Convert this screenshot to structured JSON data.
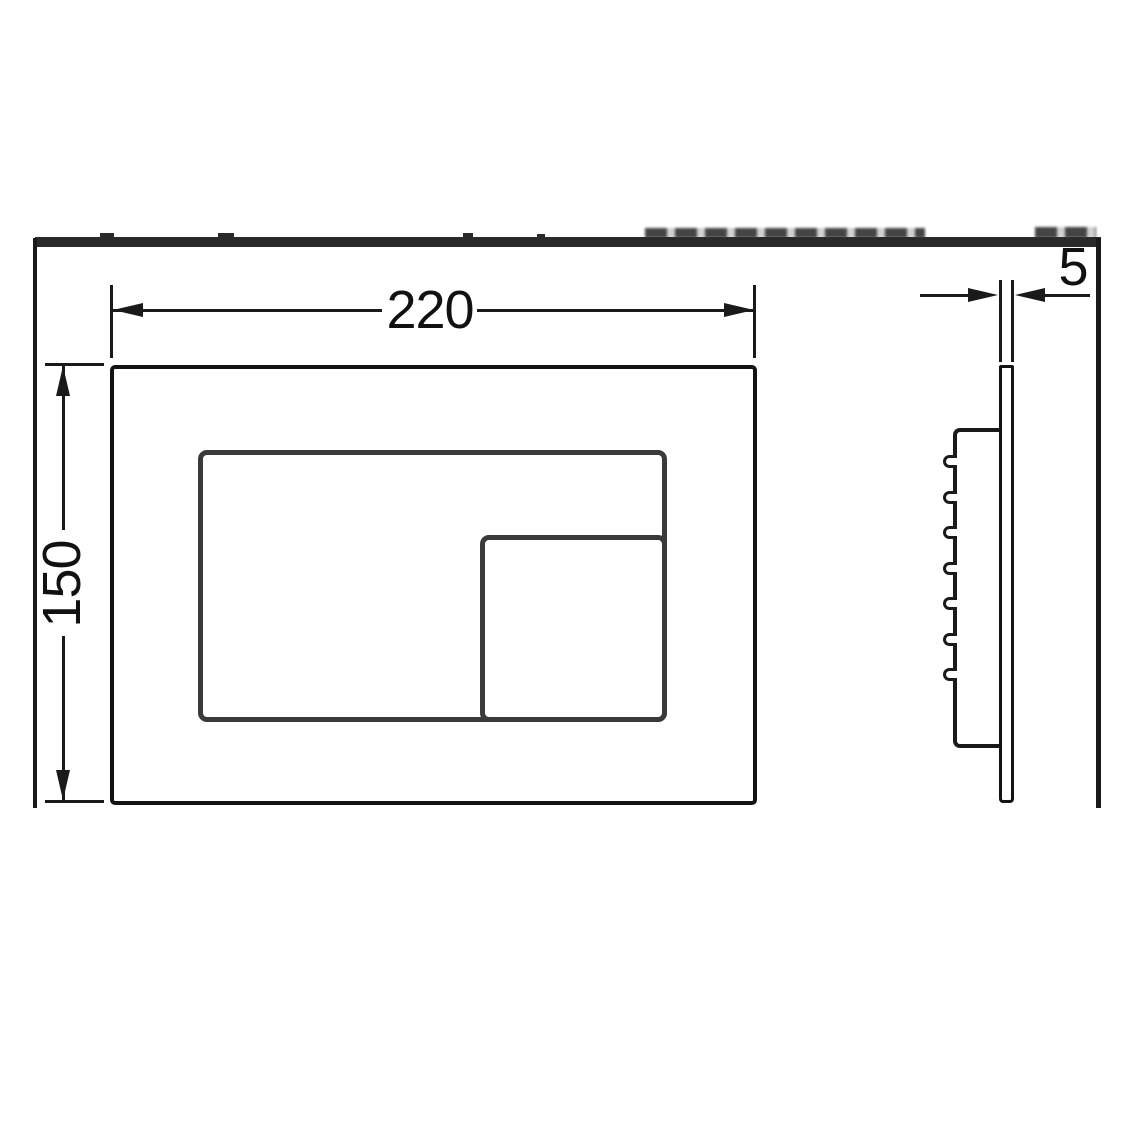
{
  "drawing": {
    "type": "technical-dimension-drawing",
    "subject": "flush-plate",
    "views": {
      "front": "front-view",
      "side": "side-profile-view"
    }
  },
  "dimensions": {
    "width": "220",
    "height": "150",
    "thickness": "5"
  },
  "side_view": {
    "clip_count": 7,
    "clip_top_start": 455,
    "clip_spacing": 35.5
  },
  "colors": {
    "line": "#1a1a1a",
    "button_border": "#3a3a3a",
    "header_strip": "#2a2a2a",
    "background": "#ffffff"
  }
}
